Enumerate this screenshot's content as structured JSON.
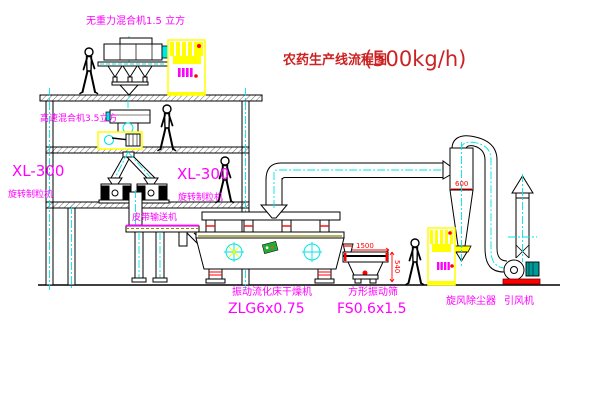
{
  "title": {
    "cn": "农药生产线流程图",
    "capacity": "(500kg/h)"
  },
  "labels": {
    "top_mixer": "无重力混合机1.5 立方",
    "speed_mixer": "高速混合机3.5立方",
    "xl300_left": "XL-300",
    "granulator_left": "旋转制粒机",
    "xl300_right": "XL-300",
    "granulator_right": "旋转制粒机",
    "belt_conveyor": "皮带输送机",
    "dryer": "振动流化床干燥机",
    "dryer_model": "ZLG6x0.75",
    "sieve": "方形振动筛",
    "sieve_model": "FS0.6x1.5",
    "cyclone": "旋风除尘器",
    "fan": "引风机"
  },
  "dimensions": {
    "cyclone_dia": "600",
    "sieve_width": "1500",
    "sieve_height": "540"
  },
  "colors": {
    "label_magenta": "#FF00FF",
    "title_red": "#CC2222",
    "dimension_red": "#FF0000",
    "equipment_yellow": "#FFFF00",
    "centerline_cyan": "#00E5E5",
    "line_black": "#000000"
  }
}
